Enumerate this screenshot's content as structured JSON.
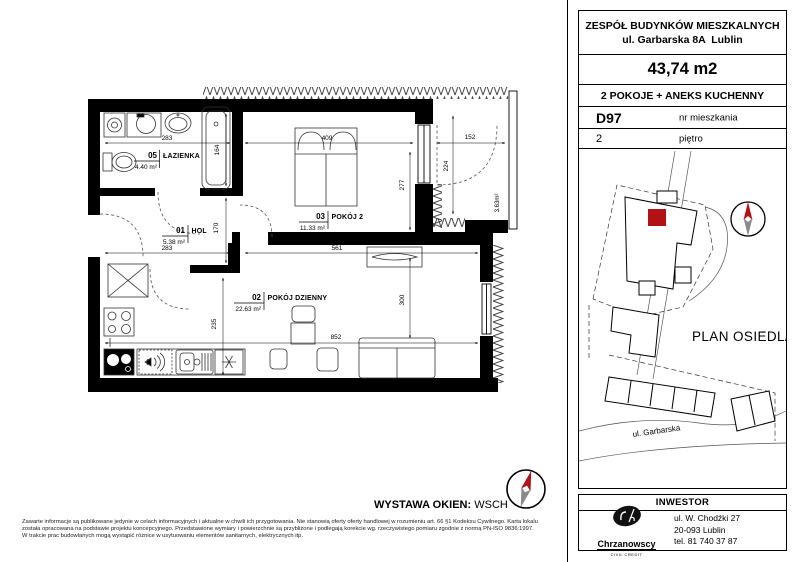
{
  "header": {
    "title_line1": "ZESPÓŁ BUDYNKÓW MIESZKALNYCH",
    "title_line2": "ul. Garbarska 8A  Lublin",
    "total_area": "43,74 m2",
    "layout": "2 POKOJE + ANEKS KUCHENNY",
    "apartment_no": "D97",
    "apartment_no_label": "nr mieszkania",
    "floor": "2",
    "floor_label": "piętro"
  },
  "site_plan": {
    "title": "PLAN OSIEDLA",
    "street": "ul. Garbarska",
    "highlight_color": "#b01216"
  },
  "investor": {
    "label": "INWESTOR",
    "logo_name": "Chrzanowscy",
    "logo_sub": "CIVIL CREDIT",
    "address_line1": "ul. W. Chodźki 27",
    "address_line2": "20-093 Lublin",
    "address_line3": "tel. 81 740 37 87"
  },
  "plan": {
    "rooms": [
      {
        "no": "05",
        "name": "ŁAZIENKA",
        "area": "4.40 m²"
      },
      {
        "no": "01",
        "name": "HOL",
        "area": "5.38 m²"
      },
      {
        "no": "03",
        "name": "POKÓJ 2",
        "area": "11.33 m²"
      },
      {
        "no": "02",
        "name": "POKÓJ DZIENNY",
        "area": "22.63 m²"
      }
    ],
    "balcony_area": "3.63m²",
    "dims": {
      "bath_w": "283",
      "bath_tub": "164",
      "hol_w": "283",
      "hol_h": "170",
      "bed_w": "409",
      "bed_h": "277",
      "balc_w": "152",
      "balc_h": "224",
      "liv_w": "561",
      "liv_h": "300",
      "liv_total": "852",
      "kitchen_h": "235"
    }
  },
  "footer": {
    "windows_label": "WYSTAWA OKIEN:",
    "windows_value": "WSCH",
    "disclaimer_line1": "Zawarte informacje są publikowane jedynie w celach informacyjnych i aktualne w chwili ich przygotowania. Nie stanowią oferty oferty handlowej w rozumieniu art. 66 §1 Kodeksu Cywilnego. Karta lokalu",
    "disclaimer_line2": "została opracowana na podstawie projektu koncepcyjnego. Przedstawione wymiary i powierzchnie są przybliżone i podlegają korekcie wg. rzeczywistego pomiaru zgodnie z normą PN-ISO 9836:1997.",
    "disclaimer_line3": "W trakcie prac budowlanych mogą wystąpić różnice w usytuowaniu elementów sanitarnych, elektrycznych itp."
  }
}
